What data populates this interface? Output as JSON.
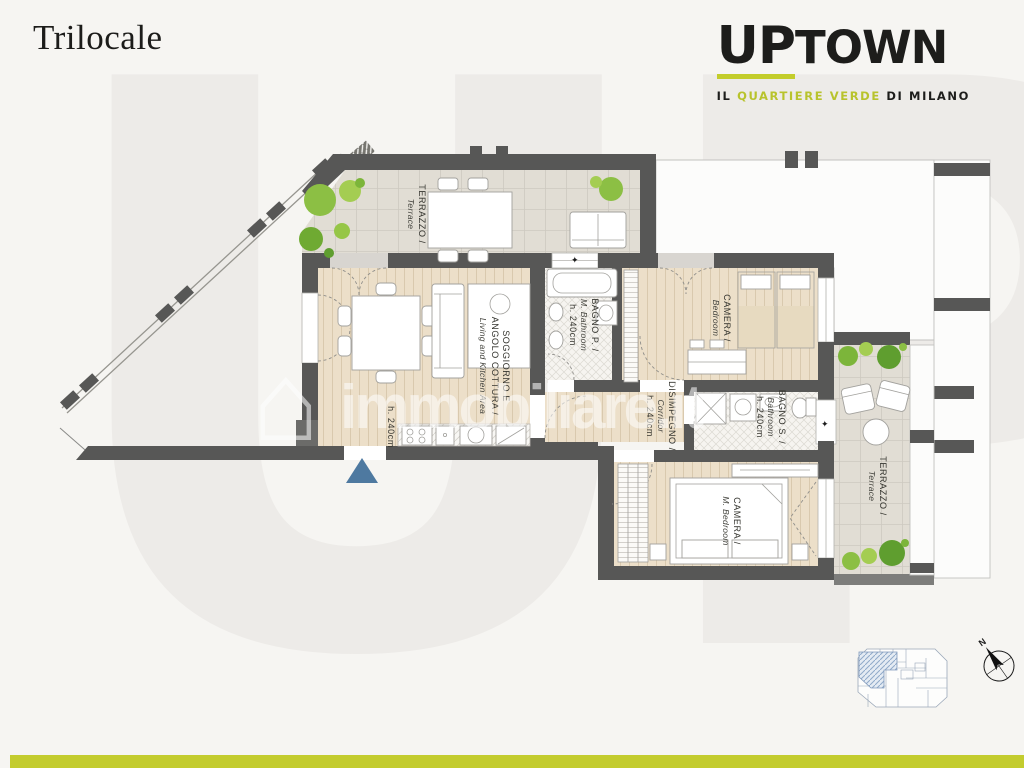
{
  "header": {
    "title": "Trilocale"
  },
  "logo": {
    "up": "UP",
    "town": "TOWN",
    "tagline": {
      "prefix": "IL",
      "highlight": "QUARTIERE VERDE",
      "suffix": "DI MILANO"
    },
    "accent_color": "#c3cd2b"
  },
  "background": {
    "letters": "UP"
  },
  "watermark": {
    "brand": "immobiliare.it",
    "house_icon": "⌂"
  },
  "plan": {
    "rooms": {
      "terrace_top": {
        "line1": "TERRAZZO /",
        "line2": "Terrace"
      },
      "living": {
        "line1": "SOGGIORNO E",
        "line2": "ANGOLO COTTURA /",
        "line3": "Living and Kitchen Area",
        "height": "h. 240cm"
      },
      "bathroom_main": {
        "line1": "BAGNO P. /",
        "line2": "M. Bathroom",
        "height": "h. 240cm"
      },
      "bedroom": {
        "line1": "CAMERA /",
        "line2": "Bedroom"
      },
      "corridor": {
        "line1": "DISIMPEGNO /",
        "line2": "Corridor",
        "height": "h. 240cm"
      },
      "bathroom_second": {
        "line1": "BAGNO S. /",
        "line2": "Bathroom",
        "height": "h. 240cm"
      },
      "bedroom_master": {
        "line1": "CAMERA /",
        "line2": "M. Bedroom"
      },
      "terrace_right": {
        "line1": "TERRAZZO /",
        "line2": "Terrace"
      }
    },
    "window_marker": "✦",
    "compass": {
      "north": "N"
    }
  },
  "colors": {
    "accent": "#c3cc2e",
    "wall": "#575756",
    "wood_floor": "#ecdfc9",
    "terrace_floor": "#e1ddd4",
    "bush_green": "#8cbf44",
    "entrance_arrow": "#4e79a0",
    "keyplan_highlight": "#8fa9c9"
  }
}
